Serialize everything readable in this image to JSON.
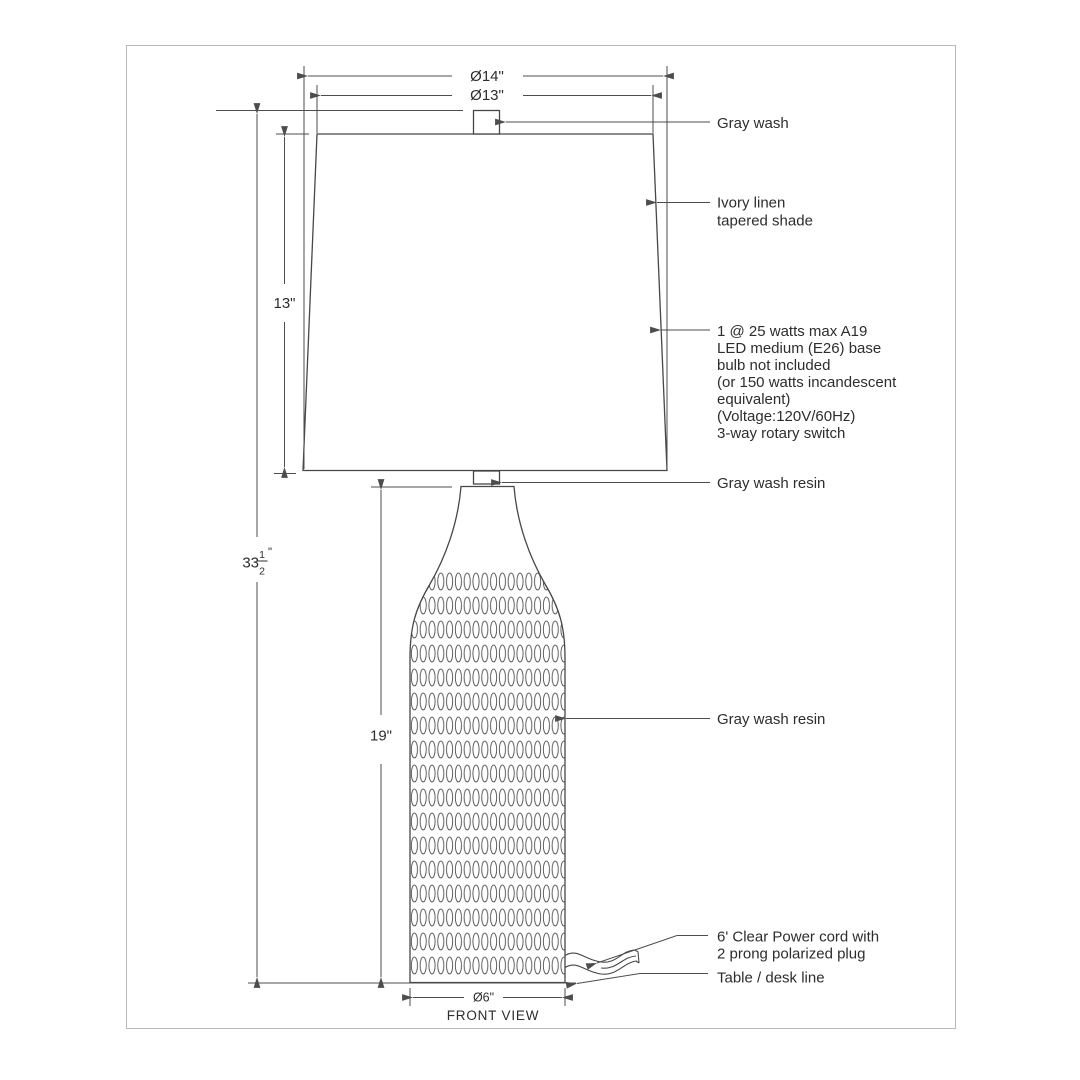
{
  "drawing": {
    "view_label": "FRONT VIEW",
    "dimensions": {
      "shade_bottom_diameter": "Ø14\"",
      "shade_top_diameter": "Ø13\"",
      "shade_height": "13\"",
      "total_height_whole": "33",
      "total_height_frac_num": "1",
      "total_height_frac_den": "2",
      "total_height_unit": "\"",
      "body_height": "19\"",
      "base_diameter": "Ø6\""
    },
    "annotations": {
      "finial": "Gray wash",
      "shade": {
        "lines": [
          "Ivory linen",
          "tapered shade"
        ]
      },
      "bulb": {
        "lines": [
          "1 @ 25 watts max A19",
          "LED medium (E26) base",
          "bulb not included",
          "(or 150 watts incandescent",
          "equivalent)",
          "(Voltage:120V/60Hz)",
          "3-way rotary switch"
        ]
      },
      "neck": "Gray wash resin",
      "body": "Gray wash resin",
      "cord": {
        "lines": [
          "6' Clear Power cord with",
          "2 prong polarized plug"
        ]
      },
      "table": "Table / desk line"
    },
    "colors": {
      "line": "#4d4d4d",
      "outline": "#474747",
      "text": "#2d2d2d",
      "frame": "#b8b8b8",
      "background": "#ffffff"
    }
  }
}
